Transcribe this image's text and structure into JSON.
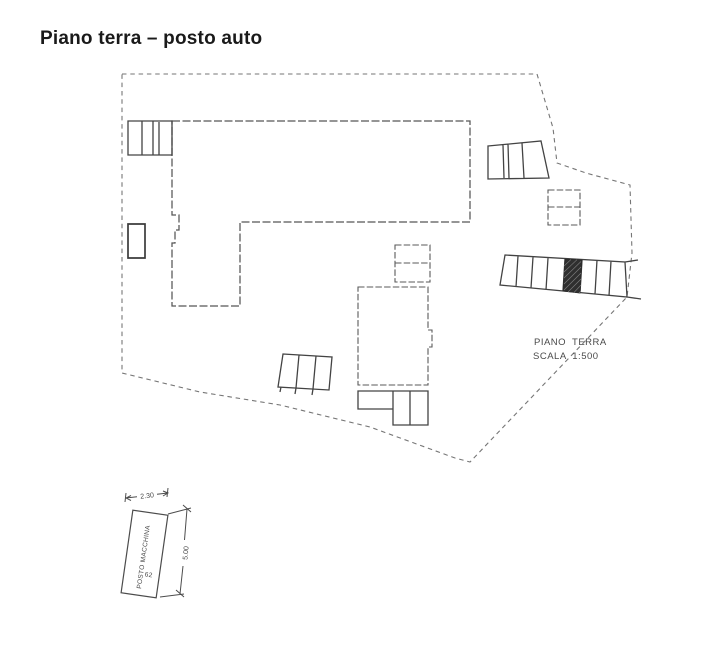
{
  "header": {
    "title": "Piano terra – posto auto"
  },
  "plan": {
    "label_line1": "PIANO TERRA",
    "label_line2": "SCALA 1:500"
  },
  "detail": {
    "stall_label": "POSTO MACCHINA",
    "stall_number": "62",
    "width_dimension": "2.30",
    "height_dimension": "5.00"
  },
  "colors": {
    "background": "#ffffff",
    "title": "#1a1a1a",
    "ink": "#4a4a4a",
    "boundary": "#767676",
    "hatch_fill": "#2f2f2f"
  }
}
